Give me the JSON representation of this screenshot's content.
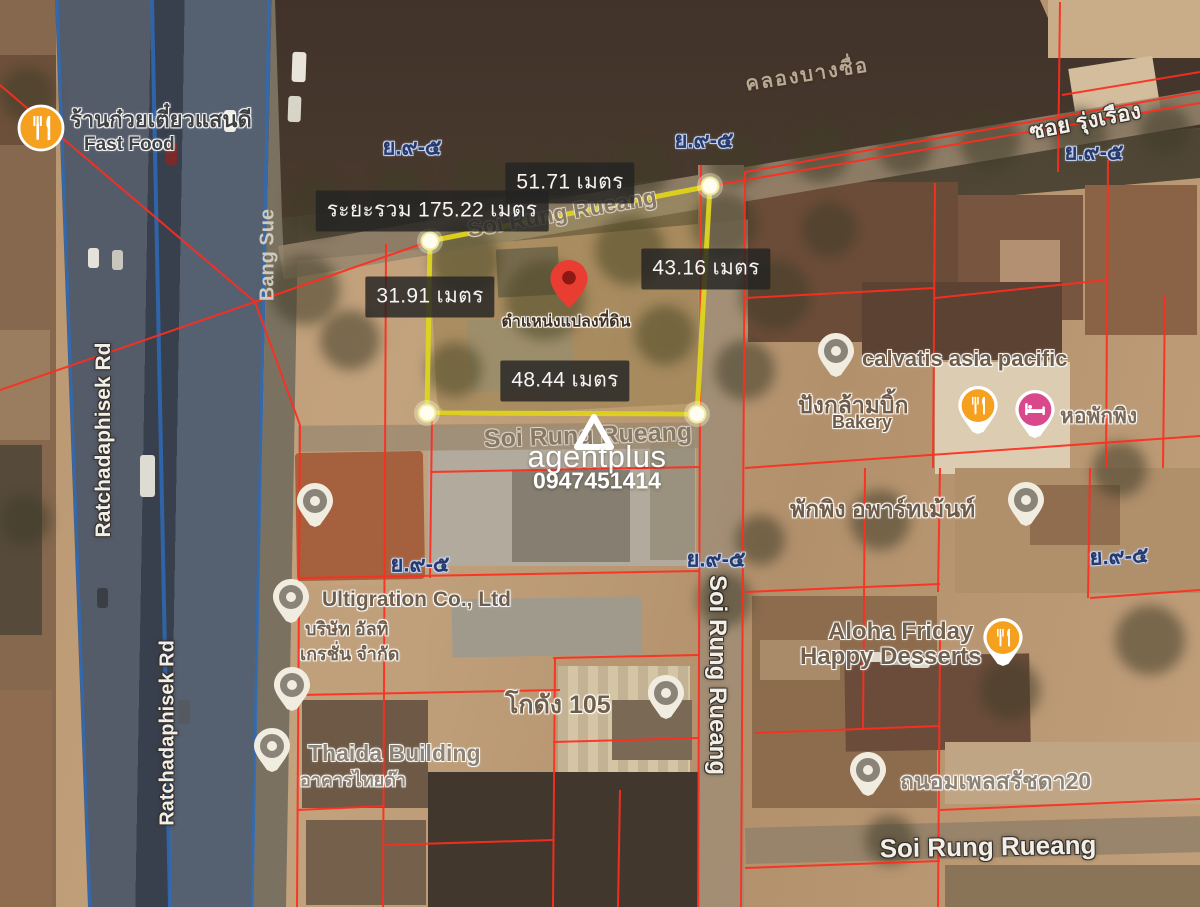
{
  "map_title": "satellite land plot map",
  "watermark": {
    "brand": "agentplus",
    "phone": "0947451414"
  },
  "plot": {
    "pin_label": "ตำแหน่งแปลงที่ดิน",
    "measurements": {
      "total": "ระยะรวม 175.22 เมตร",
      "top": "51.71 เมตร",
      "right": "43.16 เมตร",
      "left": "31.91 เมตร",
      "bottom": "48.44 เมตร"
    }
  },
  "roads": {
    "ratchadaphisek": "Ratchadaphisek Rd",
    "bang_sue": "Bang Sue",
    "soi_rung_rueang": "Soi Rung Rueang",
    "soi_rung_rueang_thai": "ซอย รุ่งเรือง",
    "canal": "คลองบางซื่อ"
  },
  "zone_label": "ย.๙-๕",
  "pois": [
    {
      "name": "ร้านก๋วยเตี๋ยวแสนดี",
      "sub": "Fast Food",
      "icon": "restaurant"
    },
    {
      "name": "calvatis asia pacific",
      "icon": "place"
    },
    {
      "name": "ปังกล้ามบิ้ก",
      "sub": "Bakery",
      "icon": "restaurant"
    },
    {
      "name": "หอพักพิง",
      "icon": "hotel"
    },
    {
      "name": "พักพิง อพาร์ทเม้นท์",
      "icon": "place"
    },
    {
      "name": "Ultigration Co., Ltd",
      "sub": "บริษัท อัลทิ",
      "sub2": "เกรชั่น จำกัด",
      "icon": "place"
    },
    {
      "name": "Aloha Friday",
      "sub": "Happy Desserts",
      "icon": "restaurant"
    },
    {
      "name": "โกดัง 105",
      "icon": "place"
    },
    {
      "name": "Thaida Building",
      "sub": "อาคารไทยด๊า",
      "icon": "place"
    },
    {
      "name": "ถนอมเพลสรัชดา20",
      "icon": "place"
    }
  ],
  "colors": {
    "parcel_line": "#ff2d1f",
    "plot_outline": "#ddd51f",
    "pin_red": "#e93d31",
    "poi_orange": "#f5a01f",
    "poi_pink": "#d9488b",
    "zone_text": "#263a6b",
    "highway_blue": "#2e6cb8"
  }
}
